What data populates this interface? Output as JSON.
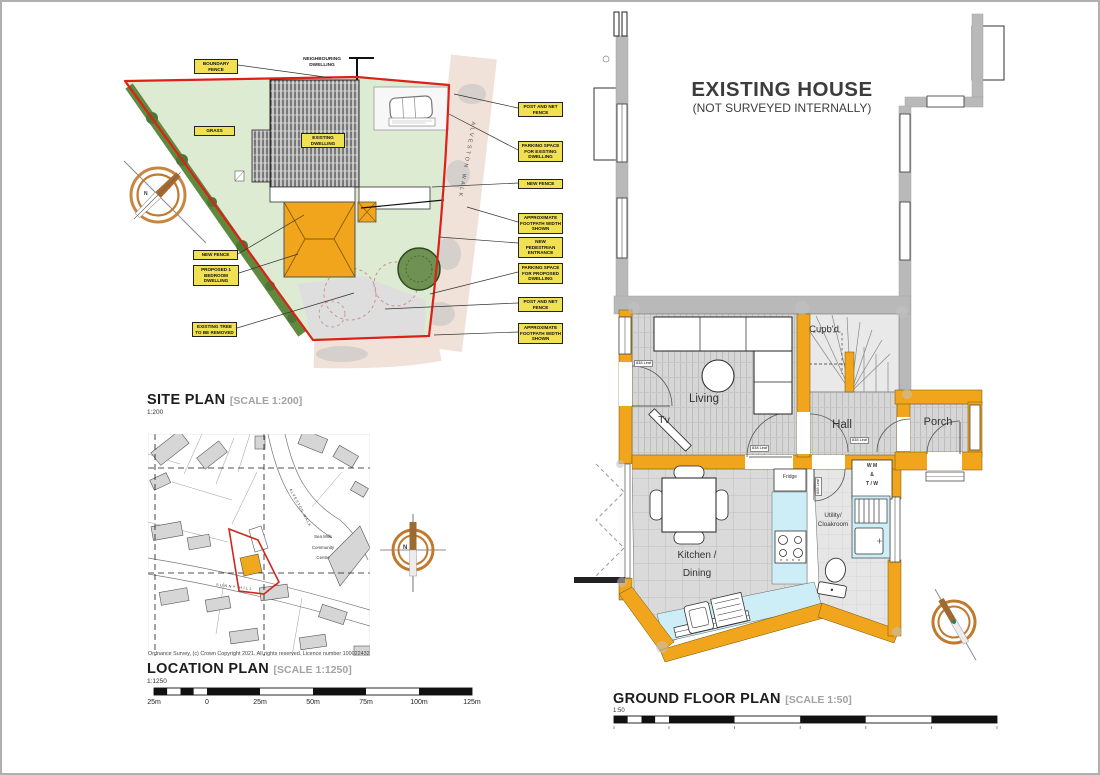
{
  "site_plan": {
    "title": "SITE PLAN",
    "scale_bracket": "[SCALE 1:200]",
    "scale_ratio": "1:200",
    "road_name": "ALVESTON WALK",
    "compass_n": "N",
    "labels": {
      "boundary_fence": "BOUNDARY FENCE",
      "neighbouring_dwelling": "NEIGHBOURING DWELLING",
      "grass": "GRASS",
      "existing_dwelling": "EXISTING DWELLING",
      "new_fence_left": "NEW FENCE",
      "proposed_dwelling": "PROPOSED 1 BEDROOM DWELLING",
      "tree_removed": "EXISTING TREE TO BE REMOVED",
      "post_net_fence_top": "POST AND NET FENCE",
      "parking_existing": "PARKING SPACE FOR EXISTING DWELLING",
      "new_fence_right": "NEW FENCE",
      "footpath_top": "APPROXIMATE FOOTPATH WIDTH SHOWN",
      "pedestrian_entrance": "NEW PEDESTRIAN ENTRANCE",
      "parking_proposed": "PARKING SPACE FOR PROPOSED DWELLING",
      "post_net_fence_bottom": "POST AND NET FENCE",
      "footpath_bottom": "APPROXIMATE FOOTPATH WIDTH SHOWN"
    }
  },
  "location_plan": {
    "title": "LOCATION PLAN",
    "scale_bracket": "[SCALE 1:1250]",
    "scale_ratio": "1:1250",
    "copyright": "Ordnance Survey, (c) Crown Copyright 2021. All rights reserved. Licence number 100022432",
    "community_centre": "Sea Mills Community Centre",
    "road_sunny_hill": "SUNNY HILL",
    "road_alveston": "ALVESTON WALK",
    "compass_n": "N",
    "scale_labels": [
      "25m",
      "0",
      "25m",
      "50m",
      "75m",
      "100m",
      "125m"
    ]
  },
  "floor_plan": {
    "heading": "EXISTING HOUSE",
    "subheading": "(NOT SURVEYED INTERNALLY)",
    "title": "GROUND FLOOR PLAN",
    "scale_bracket": "[SCALE 1:50]",
    "scale_ratio": "1:50",
    "door_label": "838 Leaf",
    "rooms": {
      "living": "Living",
      "tv": "Tv",
      "cupboard": "Cupb'd",
      "hall": "Hall",
      "porch": "Porch",
      "kitchen_line1": "Kitchen /",
      "kitchen_line2": "Dining",
      "utility_line1": "Utility/",
      "utility_line2": "Cloakroom",
      "fridge": "Fridge",
      "wm_line1": "W M",
      "wm_line2": "&",
      "wm_line3": "T / W"
    }
  },
  "colors": {
    "wall_yellow": "#f0a51c",
    "boundary_red": "#dd2018",
    "counter_cyan": "#cdeef6",
    "grass_green": "#dcebd2",
    "hedge_green": "#5f8a3e",
    "road_beige": "#f0e2d8",
    "unsurveyed_grey": "#b9b9b9",
    "compass_orange": "#c07a2e",
    "label_yellow": "#f0e052"
  }
}
